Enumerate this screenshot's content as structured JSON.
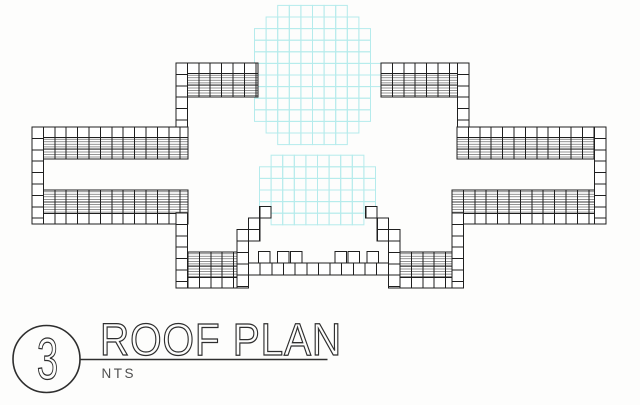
{
  "title_block": {
    "detail_number": "3",
    "title": "ROOF PLAN",
    "scale": "NTS"
  },
  "drawing": {
    "canvas": {
      "width": 640,
      "height": 405,
      "background": "#fdfdfc"
    },
    "colors": {
      "line": "#1f1f1f",
      "hatch": "#6f6f6f",
      "tree": "#b5ebec",
      "paper": "#ffffff",
      "title_text": "#2e2e2e",
      "scale_text": "#4f4f4f"
    },
    "cell": 11.4,
    "plain_row": 10.5,
    "hatch_spacing": 2.55,
    "trees": [
      {
        "cx": 312.5,
        "cy": 75,
        "rx": 64,
        "ry": 72,
        "cell": 11.6
      },
      {
        "cx": 317.5,
        "cy": 190,
        "rx": 63,
        "ry": 38,
        "cell": 11.6
      }
    ],
    "tile_bands": [
      {
        "x": 176,
        "y": 63,
        "w": 82,
        "h": 34,
        "plain": "top"
      },
      {
        "x": 381,
        "y": 63,
        "w": 88,
        "h": 34,
        "plain": "top"
      },
      {
        "x": 32,
        "y": 127,
        "w": 156,
        "h": 32,
        "plain": "top"
      },
      {
        "x": 457,
        "y": 127,
        "w": 149,
        "h": 32,
        "plain": "top"
      },
      {
        "x": 32,
        "y": 190,
        "w": 156,
        "h": 34,
        "plain": "bottom"
      },
      {
        "x": 452,
        "y": 190,
        "w": 154,
        "h": 34,
        "plain": "bottom"
      },
      {
        "x": 188,
        "y": 252,
        "w": 49,
        "h": 36,
        "plain": "bottom"
      },
      {
        "x": 400,
        "y": 252,
        "w": 52,
        "h": 36,
        "plain": "bottom"
      }
    ],
    "square_columns": [
      {
        "x": 176,
        "y": 63,
        "h": 64
      },
      {
        "x": 457.5,
        "y": 63,
        "h": 64
      },
      {
        "x": 32,
        "y": 127,
        "h": 97
      },
      {
        "x": 594.5,
        "y": 127,
        "h": 97
      },
      {
        "x": 176,
        "y": 213,
        "h": 75
      },
      {
        "x": 452,
        "y": 213,
        "h": 75
      },
      {
        "x": 237,
        "y": 241,
        "h": 47
      },
      {
        "x": 388.6,
        "y": 241,
        "h": 47
      }
    ],
    "square_rows": [
      {
        "x": 248.5,
        "y": 263,
        "w": 140,
        "h": 12,
        "pitch": 11.65
      }
    ],
    "squares": [
      [
        258.5,
        251.6
      ],
      [
        277.5,
        251.6
      ],
      [
        290.5,
        251.6
      ],
      [
        335.1,
        251.6
      ],
      [
        348.1,
        251.6
      ],
      [
        367.1,
        251.6
      ],
      [
        237,
        229.5
      ],
      [
        248.4,
        229.5
      ],
      [
        248.4,
        218.1
      ],
      [
        259.8,
        206.7
      ],
      [
        388.6,
        229.5
      ],
      [
        377.2,
        229.5
      ],
      [
        377.2,
        218.1
      ],
      [
        365.8,
        206.7
      ]
    ]
  }
}
